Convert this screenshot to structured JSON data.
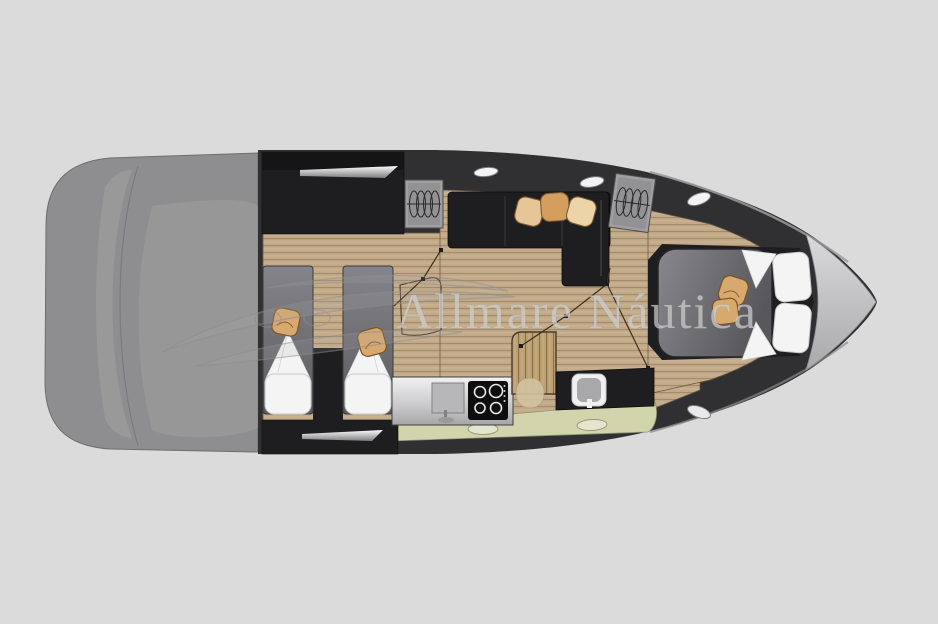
{
  "watermark": {
    "text": "Allmare Náutica",
    "logo_icon": "speedboat-logo-icon"
  },
  "palette": {
    "background": "#dbdbdb",
    "hull_dark": "#303033",
    "deck_gray": "#8e8e90",
    "deck_gray_light": "#9c9c9e",
    "wood": "#c2aa89",
    "wood_line": "#9a8060",
    "furniture_dark": "#1e1e20",
    "mattress_gray": "#77777d",
    "pillow_white": "#f4f4f4",
    "cushion_tan": "#d8a96e",
    "floor_green": "#d2d5ab",
    "steel_counter": "#d9d9db",
    "bow_tip_silver": "#c9c9cb",
    "watermark_gray": "#cecece"
  },
  "icons": {
    "porthole-icon": "ellipse",
    "roof-hatch-icon": "spring-coil",
    "cooktop-icon": "four-burner-rings",
    "sink-icon": "square-basin",
    "toilet-icon": "rounded-seat",
    "stairs-icon": "slatted-steps",
    "speedboat-logo-icon": "crescent-hull-outline"
  }
}
